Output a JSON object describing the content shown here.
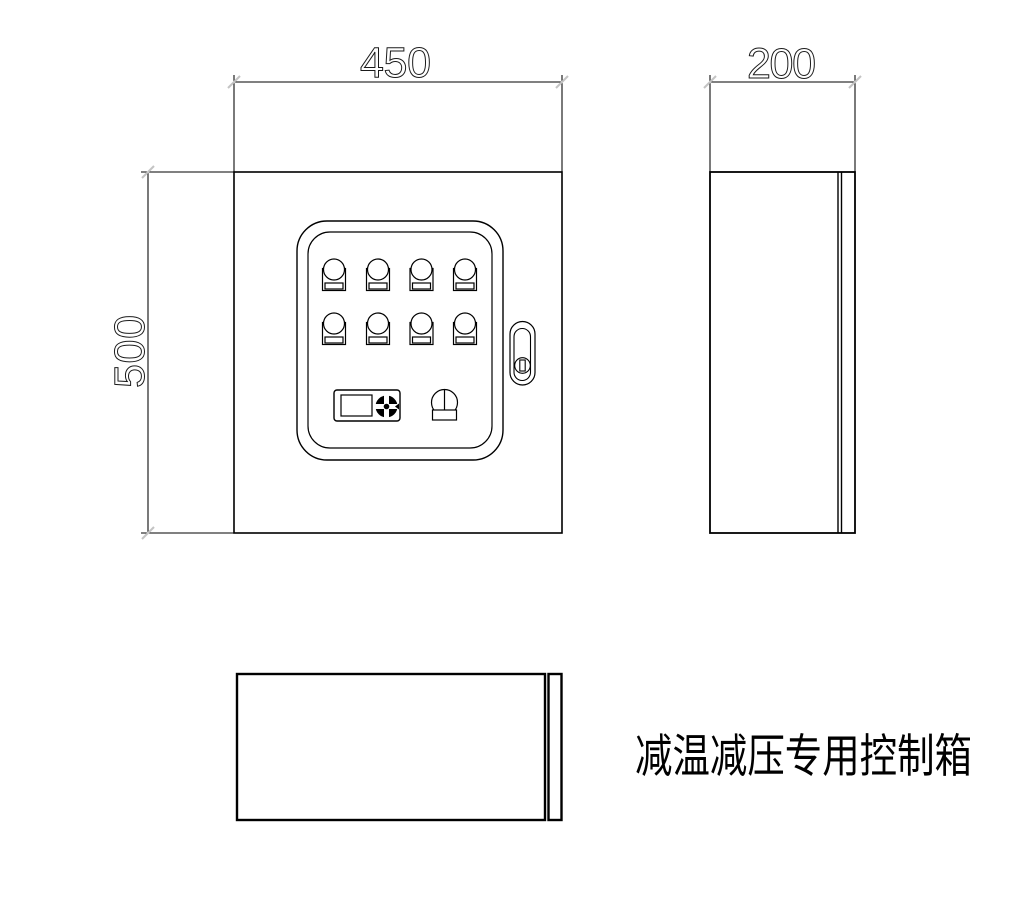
{
  "drawing": {
    "title": "减温减压专用控制箱",
    "dimensions": {
      "front_width": "450",
      "front_height": "500",
      "side_depth": "200"
    },
    "views": {
      "front": "front-view",
      "side": "side-view",
      "top": "top-view"
    },
    "panel": {
      "indicator_count": 8,
      "rows": 2,
      "columns": 4,
      "controls": [
        "meter-display",
        "selector-knob",
        "rotary-switch"
      ],
      "door": [
        "door-handle",
        "keyhole"
      ]
    },
    "colors": {
      "line": "#000000",
      "dim_tick": "#c3c3c3",
      "background": "#ffffff"
    }
  }
}
